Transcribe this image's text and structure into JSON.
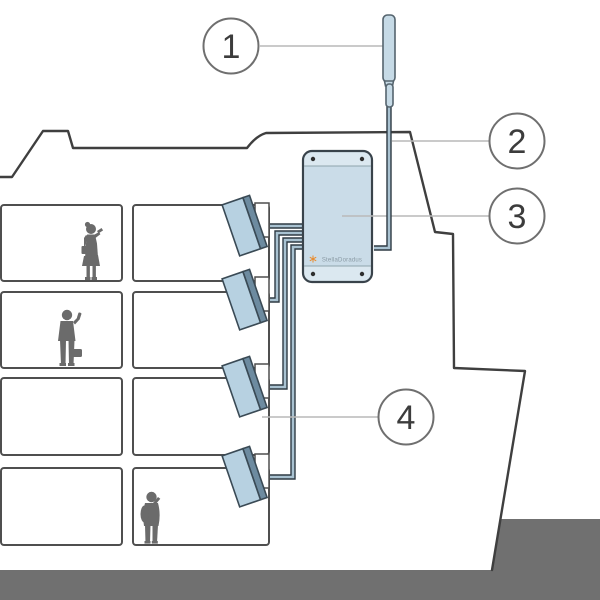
{
  "callouts": [
    {
      "number": "1"
    },
    {
      "number": "2"
    },
    {
      "number": "3"
    },
    {
      "number": "4"
    }
  ],
  "booster": {
    "logo_text": "StellaDoradus"
  },
  "colors": {
    "panel_blue": "#b7d1e1",
    "panel_edge": "#6d8ba0",
    "device_fill": "#cadce8",
    "device_strip": "#dbe8f0",
    "device_border": "#39434b",
    "cable_dark": "#2e3a43",
    "cable_light": "#a9c2d1",
    "outline": "#3f3f3f",
    "room_stroke": "#4f4f4f",
    "ground": "#707070",
    "person": "#6b6b6b",
    "leader": "#b9b9b9",
    "logo_orange": "#e98b2d",
    "antenna_fill": "#c6dae6"
  }
}
